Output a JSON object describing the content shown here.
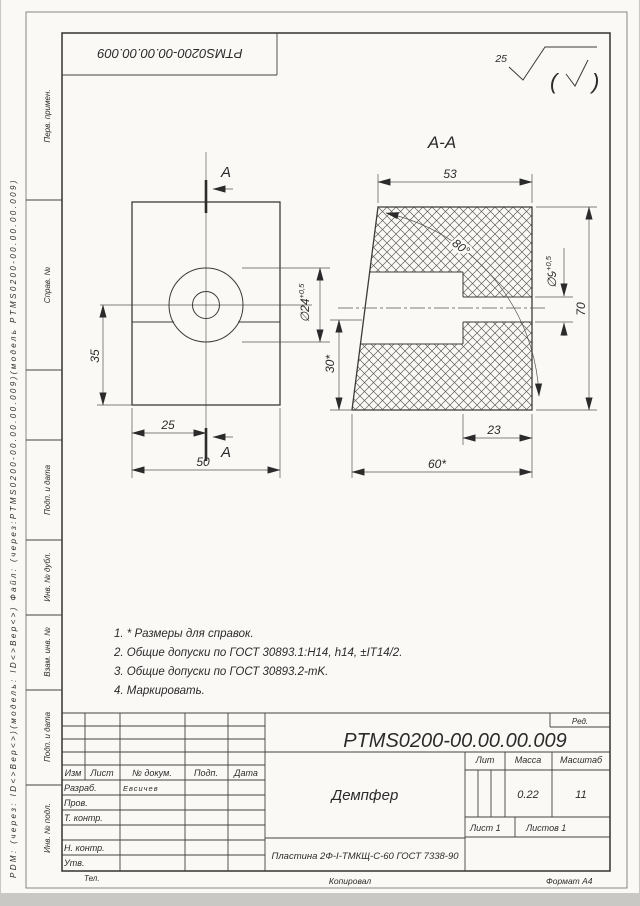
{
  "sheet": {
    "top_designation": "PTMS0200-00.00.00.009",
    "margin_pdm_text": "PDM: (через: ID<>Вер<>)(модель: ID<>Вер<>) Файл: (через:PTMS0200-00.00.00.009)(модель PTMS0200-00.00.00.009)",
    "roughness": {
      "value": "25",
      "paren_open": "(",
      "paren_close": ")"
    },
    "bottom": {
      "tel": "Тел.",
      "copied": "Копировал",
      "format": "Формат А4"
    }
  },
  "side_labels": [
    "Перв. примен.",
    "Справ. №",
    "Подп. и дата",
    "Инв. № дубл.",
    "Взам. инв. №",
    "Подп. и дата",
    "Инв. № подл."
  ],
  "drawing": {
    "section_title": "А-А",
    "cut_label_top": "А",
    "cut_label_bottom": "А",
    "dims": {
      "front_height": "35",
      "front_hole_x": "25",
      "front_width": "50",
      "dia24": "∅24",
      "dia24_tol": "+0,5",
      "sec_top_width": "53",
      "sec_angle": "80°",
      "dia9": "∅9",
      "dia9_tol": "+0,5",
      "sec_height": "70",
      "sec_step_height": "30*",
      "sec_step_width": "23",
      "sec_bottom_width": "60*"
    }
  },
  "notes": [
    "1. * Размеры для справок.",
    "2. Общие допуски по ГОСТ 30893.1:H14, h14,  ±IT14/2.",
    "3. Общие допуски по ГОСТ 30893.2-mK.",
    "4. Маркировать."
  ],
  "title_block": {
    "designation": "PTMS0200-00.00.00.009",
    "red_label": "Ред.",
    "part_name": "Демпфер",
    "material": "Пластина 2Ф-I-ТМКЩ-С-60 ГОСТ 7338-90",
    "columns": {
      "izm": "Изм",
      "list": "Лист",
      "dokum": "№ докум.",
      "podp": "Подп.",
      "data": "Дата"
    },
    "rows": {
      "razrab": "Разраб.",
      "razrab_name": "Евсичев",
      "prov": "Пров.",
      "t_kontr": "Т. контр.",
      "n_kontr": "Н. контр.",
      "utv": "Утв."
    },
    "lit_label": "Лит",
    "mass_label": "Масса",
    "mass_value": "0.22",
    "scale_label": "Масштаб",
    "scale_value": "11",
    "sheet_label": "Лист 1",
    "sheets_label": "Листов 1"
  }
}
